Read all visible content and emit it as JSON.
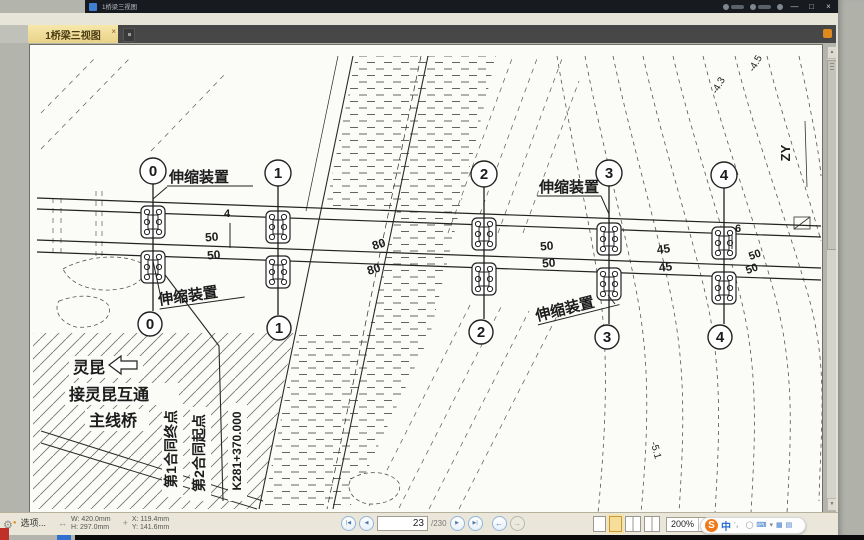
{
  "titlebar": {
    "title": "1桥梁三视图",
    "minimize": "—",
    "maximize": "□",
    "close": "×"
  },
  "tabbar": {
    "active_tab": "1桥梁三视图",
    "tab_close": "×"
  },
  "statusbar": {
    "options": "选项...",
    "size_icon": "↔",
    "width": "W: 420.0mm",
    "height": "H: 297.0mm",
    "pos_icon": "+",
    "x": "X: 119.4mm",
    "y": "Y: 141.6mm"
  },
  "nav": {
    "first": "|◀",
    "prev": "◀",
    "page": "23",
    "total": "/230",
    "next": "▶",
    "last": "▶|",
    "back": "←",
    "forward": "→"
  },
  "zoom": {
    "value": "200%",
    "caret": "▾",
    "zoom_out": "⊖"
  },
  "scroll": {
    "up": "▲",
    "down": "▼"
  },
  "gear": "⚙",
  "ime": {
    "logo": "S",
    "mode": "中",
    "icons": [
      "’，",
      "◯",
      "⌨",
      "▾",
      "▦",
      "▤"
    ]
  },
  "drawing": {
    "piers": [
      "0",
      "1",
      "2",
      "3",
      "4"
    ],
    "joint": "伸缩装置",
    "dims": {
      "d4": "4",
      "d50a": "50",
      "d50b": "50",
      "d80a": "80",
      "d80b": "80",
      "d50c": "50",
      "d50d": "50",
      "d45a": "45",
      "d45b": "45",
      "d6": "6",
      "d50e": "50",
      "d50f": "50"
    },
    "notes": {
      "lingkun": "灵昆",
      "ramp": "接灵昆互通",
      "mainline": "主线桥",
      "contract1": "第1合同终点",
      "contract2": "第2合同起点",
      "stake": "K281+370.000",
      "zy": "ZY",
      "elev1": "-4.5",
      "elev2": "-4.3",
      "elev3": "-5.1"
    }
  }
}
